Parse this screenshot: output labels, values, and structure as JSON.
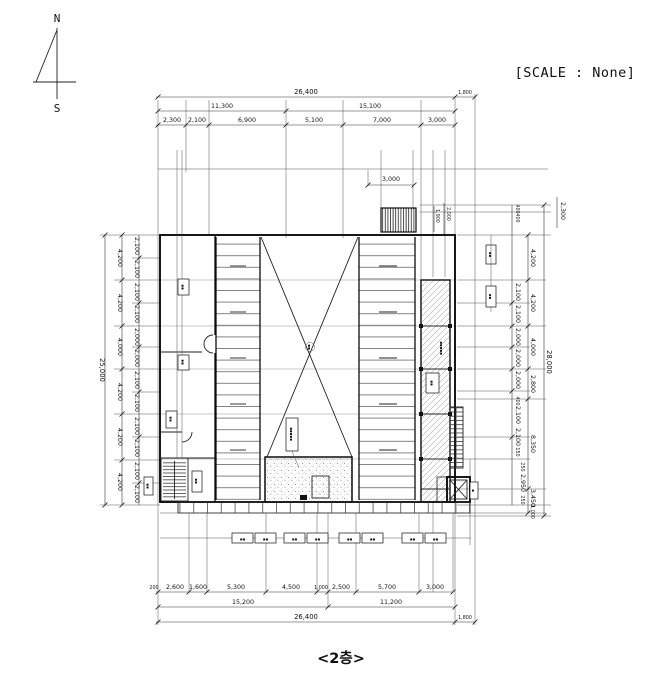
{
  "compass": {
    "north": "N",
    "south": "S"
  },
  "scale_note": "[SCALE : None]",
  "title": "<2층>",
  "dims": {
    "top": {
      "total": "26,400",
      "offset": "1,800",
      "row2": [
        "11,300",
        "15,100"
      ],
      "row3": [
        "2,300",
        "2,100",
        "6,900",
        "5,100",
        "7,000",
        "3,000"
      ],
      "louver": "3,000",
      "louver_side": [
        "1,900",
        "2,000"
      ]
    },
    "bottom": {
      "row1": [
        "200",
        "2,600",
        "1,600",
        "5,300",
        "4,500",
        "1,000",
        "2,500",
        "5,700",
        "3,000"
      ],
      "row2": [
        "15,200",
        "11,200"
      ],
      "total": "26,400",
      "offset": "1,800"
    },
    "left": {
      "total": "25,000",
      "mid": [
        "4,200",
        "4,200",
        "4,000",
        "4,200",
        "4,200",
        "4,200"
      ],
      "inner": [
        "2,100",
        "2,100",
        "2,100",
        "2,100",
        "2,000",
        "2,000",
        "2,100",
        "2,100",
        "2,100",
        "2,100",
        "2,100",
        "2,100"
      ]
    },
    "right": {
      "total": "28,000",
      "top": "2,300",
      "mid": [
        "4,200",
        "4,200",
        "4,000",
        "2,800",
        "8,350",
        "3,450",
        "1,000"
      ],
      "inner": [
        "400",
        "400",
        "2,100",
        "2,100",
        "2,000",
        "2,000",
        "2,000",
        "400",
        "2,100",
        "2,100",
        "150",
        "250",
        "2,950",
        "250"
      ]
    }
  },
  "tags": {
    "pair": "▪▪",
    "micro": "▪▪▪▪▪",
    "single": "▪"
  }
}
